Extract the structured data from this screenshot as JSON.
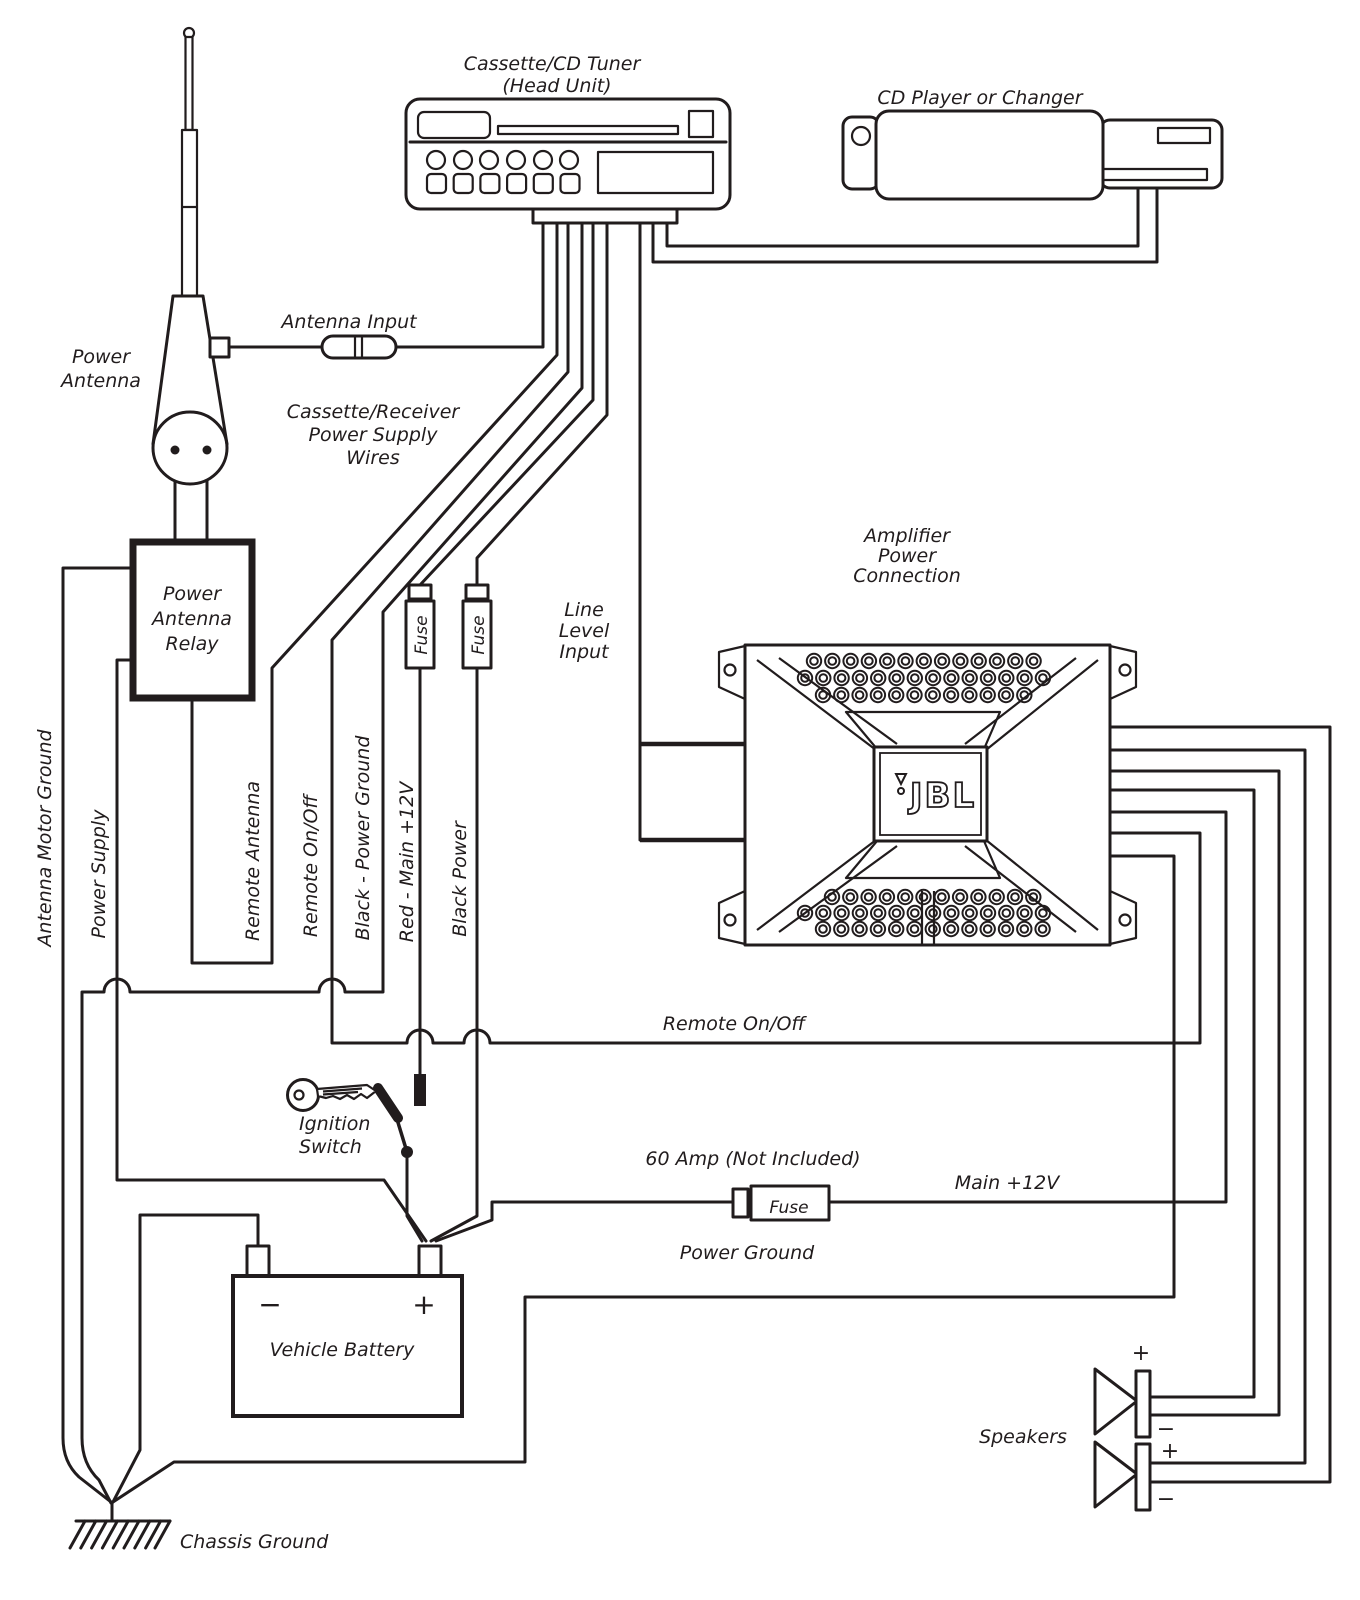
{
  "head_unit": {
    "title": "Cassette/CD Tuner",
    "subtitle": "(Head Unit)"
  },
  "cd_player": {
    "label": "CD Player or Changer"
  },
  "power_antenna": {
    "label_line1": "Power",
    "label_line2": "Antenna"
  },
  "antenna_input": {
    "label": "Antenna Input"
  },
  "supply_wires_note": {
    "line1": "Cassette/Receiver",
    "line2": "Power Supply",
    "line3": "Wires"
  },
  "relay": {
    "line1": "Power",
    "line2": "Antenna",
    "line3": "Relay"
  },
  "wires": {
    "antenna_motor_ground": "Antenna Motor Ground",
    "power_supply": "Power Supply",
    "remote_antenna": "Remote Antenna",
    "remote_on_off": "Remote On/Off",
    "black_power_ground": "Black - Power Ground",
    "red_main_12v": "Red - Main +12V",
    "black_power": "Black Power",
    "remote_run": "Remote On/Off",
    "main_12v": "Main +12V",
    "power_ground": "Power Ground"
  },
  "fuses": {
    "label": "Fuse",
    "amp_fuse_note": "60 Amp (Not Included)"
  },
  "line_level": {
    "line1": "Line",
    "line2": "Level",
    "line3": "Input"
  },
  "amplifier": {
    "note1": "Amplifier",
    "note2": "Power",
    "note3": "Connection",
    "logo": "JBL"
  },
  "ignition": {
    "line1": "Ignition",
    "line2": "Switch"
  },
  "battery": {
    "label": "Vehicle Battery",
    "minus": "−",
    "plus": "+"
  },
  "chassis_ground": {
    "label": "Chassis Ground"
  },
  "speakers": {
    "label": "Speakers",
    "s1_plus": "+",
    "s1_minus": "−",
    "s2_plus": "+",
    "s2_minus": "−"
  }
}
